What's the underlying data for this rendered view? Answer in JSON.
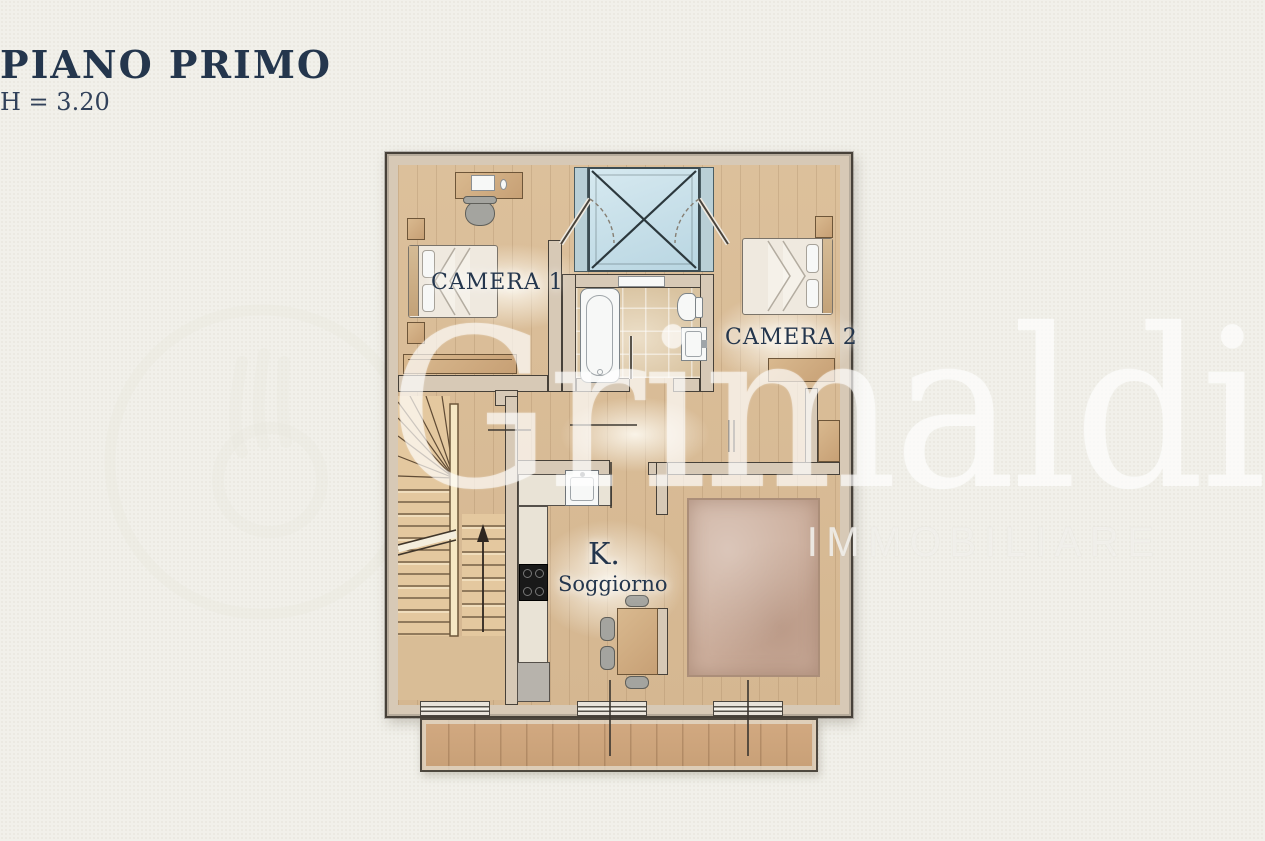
{
  "header": {
    "title": "PIANO PRIMO",
    "subtitle": "H = 3.20"
  },
  "floorplan": {
    "rooms": [
      {
        "id": "camera1",
        "label": "CAMERA 1"
      },
      {
        "id": "camera2",
        "label": "CAMERA 2"
      },
      {
        "id": "kitchen_living",
        "label_short": "K.",
        "label": "Soggiorno"
      }
    ],
    "fixtures": [
      "double-bed",
      "desk",
      "office-chair",
      "nightstand",
      "wardrobe",
      "skylight-void",
      "bathtub",
      "toilet",
      "washbasin",
      "staircase",
      "kitchen-sink",
      "cooktop",
      "refrigerator",
      "dining-table",
      "chair",
      "rug",
      "balcony",
      "window",
      "door"
    ]
  },
  "watermark": {
    "brand": "Grimaldi",
    "subbrand": "IMMOBILIARE"
  },
  "colors": {
    "background": "#f1f0ea",
    "title_ink": "#24364d",
    "wall_fill": "#d7c9b6",
    "wall_edge": "#474139",
    "wood_floor": "#d9bd97",
    "balcony_wood": "#cfa780",
    "tile_floor": "#d9c3a0",
    "skylight_glass": "#c6dfe9",
    "fixture_white": "#f7f8f7",
    "counter_stone": "#e9e3d6",
    "rug": "#cbad9b",
    "furniture_wood": "#d3b288",
    "watermark_white": "rgba(255,255,255,0.55)"
  }
}
